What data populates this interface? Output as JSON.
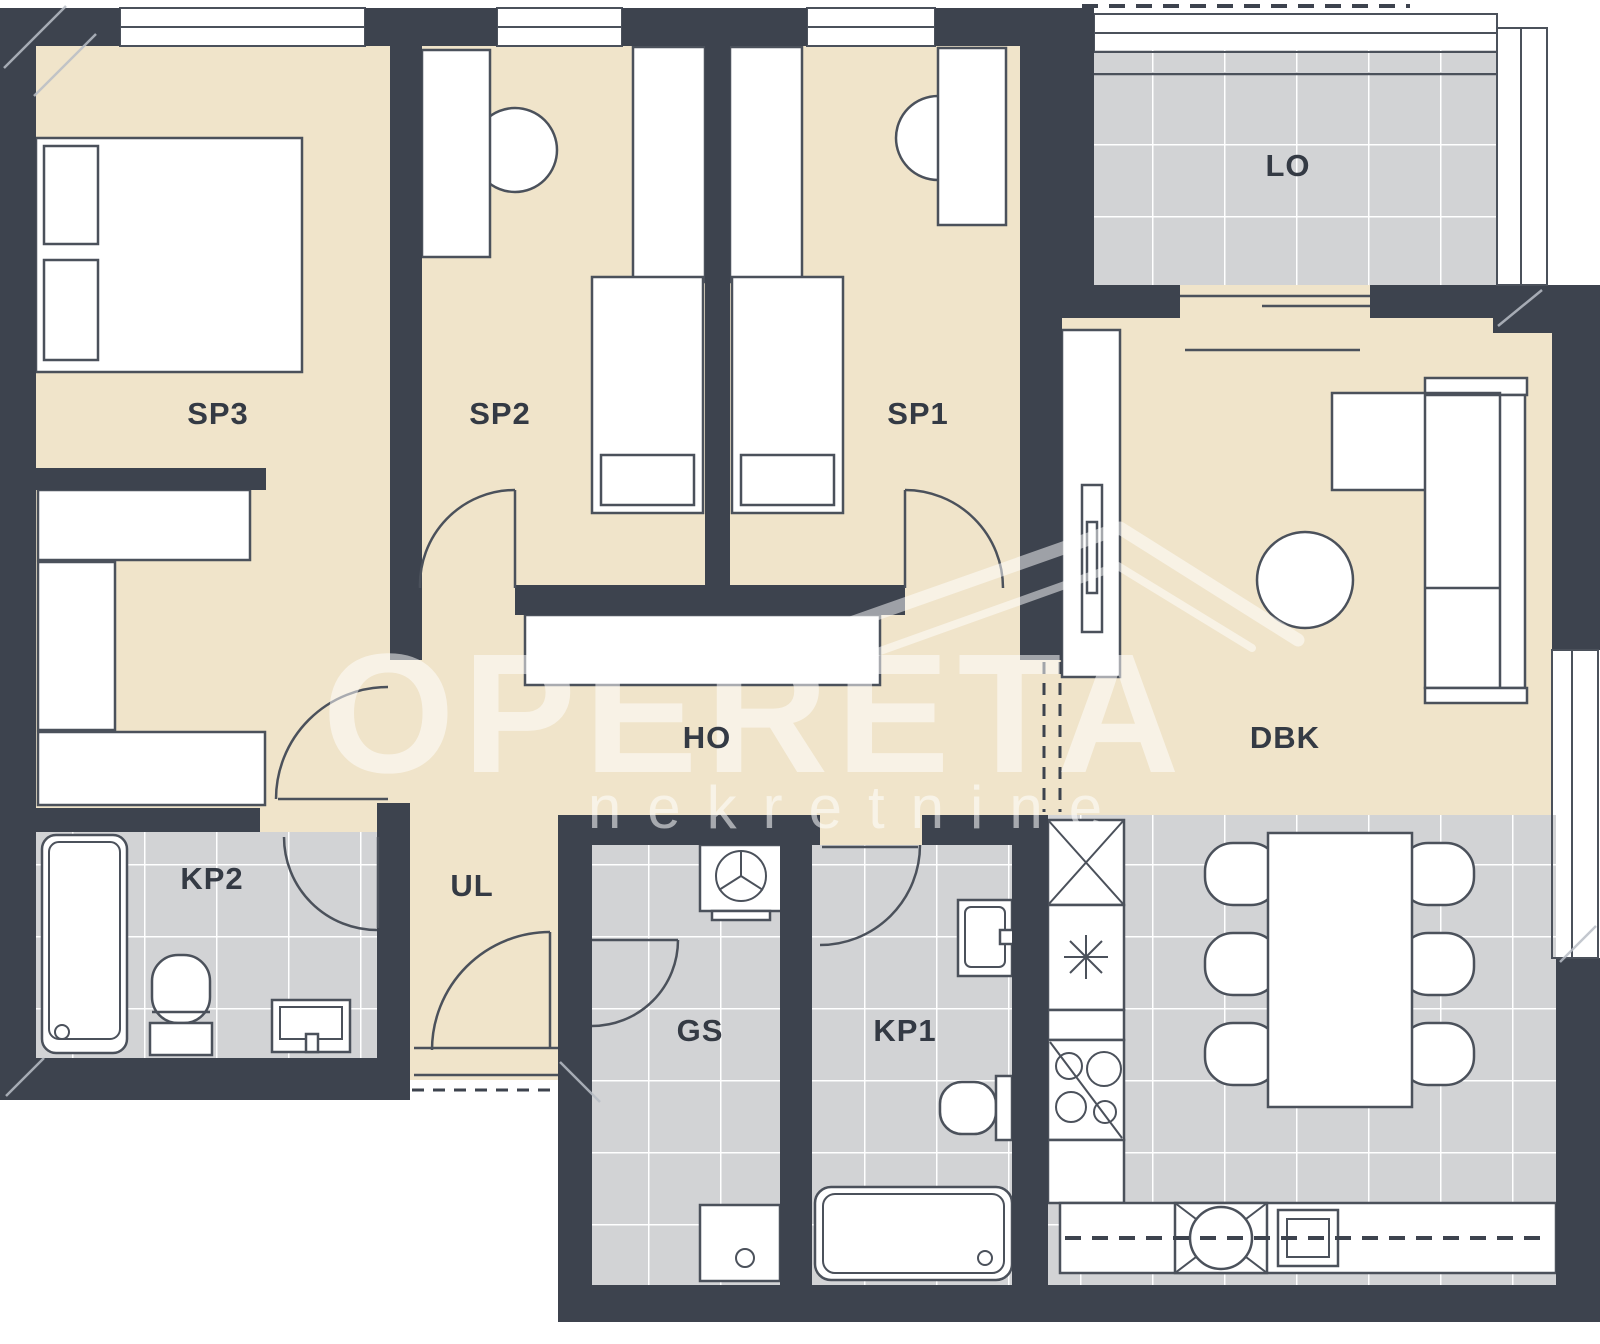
{
  "title": "apartment-floor-plan",
  "watermark": {
    "brand": "OPERETA",
    "tagline": "nekretnine"
  },
  "colors": {
    "wall": "#3d434e",
    "floor_living": "#f0e4ca",
    "floor_tile": "#d2d3d5",
    "tile_grid": "#ffffff",
    "outline": "#4b515b",
    "label": "#343a44",
    "watermark": "rgba(255,255,255,0.52)"
  },
  "rooms": [
    {
      "id": "sp3",
      "label": "SP3"
    },
    {
      "id": "sp2",
      "label": "SP2"
    },
    {
      "id": "sp1",
      "label": "SP1"
    },
    {
      "id": "lo",
      "label": "LO"
    },
    {
      "id": "ho",
      "label": "HO"
    },
    {
      "id": "dbk",
      "label": "DBK"
    },
    {
      "id": "kp2",
      "label": "KP2"
    },
    {
      "id": "ul",
      "label": "UL"
    },
    {
      "id": "gs",
      "label": "GS"
    },
    {
      "id": "kp1",
      "label": "KP1"
    }
  ]
}
